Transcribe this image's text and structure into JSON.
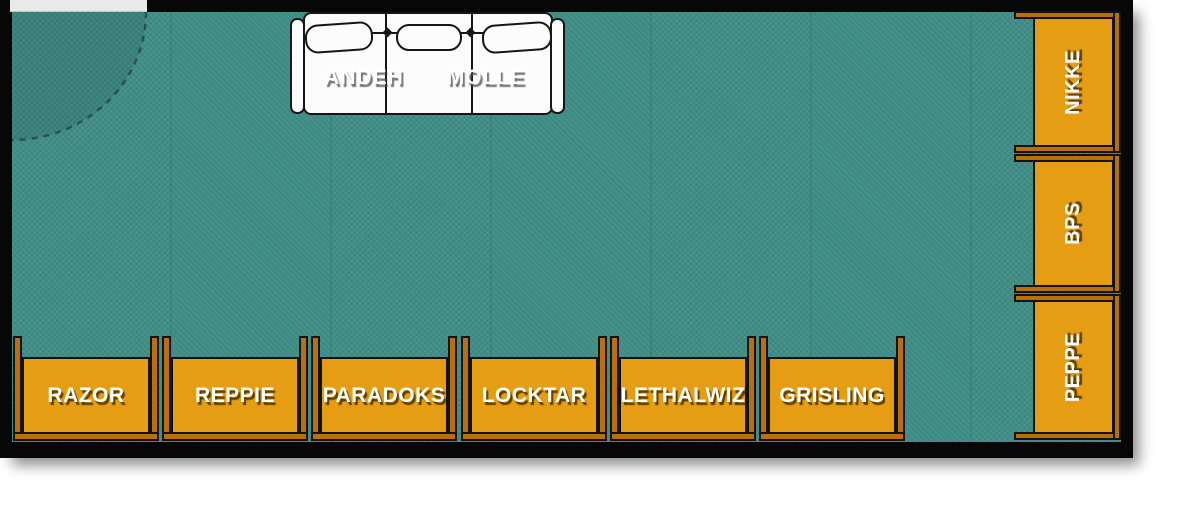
{
  "scene": {
    "type": "room floor plan seat map",
    "door_position": "top-left"
  },
  "couch": {
    "labels": [
      {
        "name": "ANDEH"
      },
      {
        "name": "MOLLE"
      }
    ]
  },
  "desks": {
    "bottom_row": [
      {
        "name": "RAZOR"
      },
      {
        "name": "REPPIE"
      },
      {
        "name": "PARADOKS"
      },
      {
        "name": "LOCKTAR"
      },
      {
        "name": "LETHALWIZ"
      },
      {
        "name": "GRISLING"
      }
    ],
    "right_column": [
      {
        "name": "NIKKE"
      },
      {
        "name": "BPS"
      },
      {
        "name": "PEPPE"
      }
    ]
  },
  "colors": {
    "floor": "#3F8E86",
    "wall": "#070707",
    "desk_frame": "#B9700A",
    "desk_surface": "#E59D13",
    "couch": "#FCFCFC",
    "label_text": "#FFFFFF",
    "door_gap": "#E9E9E9",
    "door_swing_dash": "#2C4356"
  }
}
